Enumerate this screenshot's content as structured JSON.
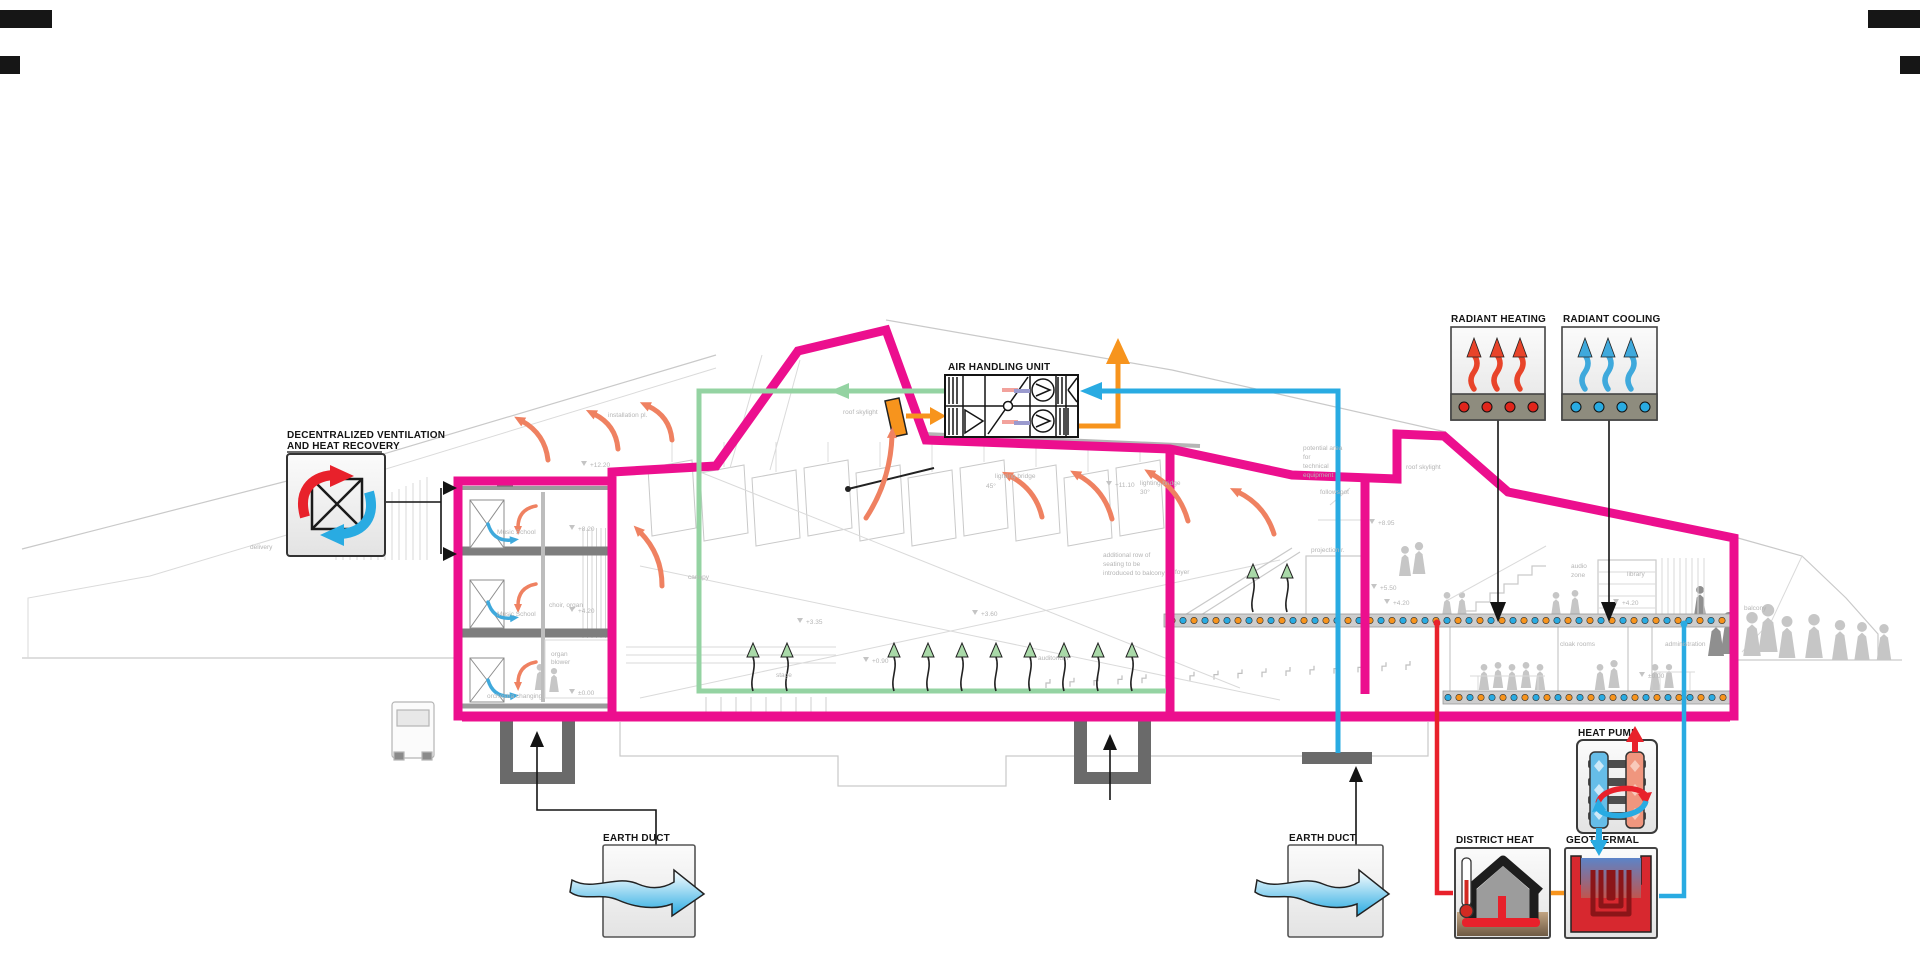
{
  "labels": {
    "decent1": "DECENTRALIZED VENTILATION",
    "decent2": "AND HEAT RECOVERY",
    "ahu": "AIR HANDLING UNIT",
    "radiant_heating": "RADIANT HEATING",
    "radiant_cooling": "RADIANT COOLING",
    "earth_duct_left": "EARTH DUCT",
    "earth_duct_right": "EARTH DUCT",
    "district_heat": "DISTRICT HEAT",
    "geothermal": "GEOTHERMAL",
    "heat_pump": "HEAT PUMP"
  },
  "colors": {
    "envelope_magenta": "#EC0F8E",
    "supply_green": "#94D3A2",
    "cool_blue": "#29ABE2",
    "warm_orange": "#F7941D",
    "exhaust_salmon": "#EF8161",
    "district_red": "#E8212B",
    "drawing_gray": "#c9c9c9"
  },
  "icons": {
    "heat_recovery_icon": "crossed red and blue rotating arrows over heat exchanger",
    "air_handling_unit_icon": "schematic with filters, cross heat exchanger and fans",
    "radiant_heating_icon": "three red wavy arrows rising from heated slab",
    "radiant_cooling_icon": "three blue wavy arrows rising from cooled slab",
    "earth_duct_icon": "blue wavy air arrow passing through ground box",
    "district_heat_icon": "house with thermometer and buried red supply pipe",
    "geothermal_icon": "red ground-loop coil below blue-to-warm gradient earth",
    "heat_pump_icon": "refrigerant cycle arrows between cold and warm coils"
  },
  "annotations": [
    {
      "text": "delivery",
      "x": 250,
      "y": 549
    },
    {
      "text": "Music School",
      "x": 497,
      "y": 534
    },
    {
      "text": "+8.20",
      "x": 578,
      "y": 531
    },
    {
      "text": "Music School",
      "x": 497,
      "y": 616
    },
    {
      "text": "+4.20",
      "x": 578,
      "y": 613
    },
    {
      "text": "orchestra changing",
      "x": 487,
      "y": 698
    },
    {
      "text": "±0.00",
      "x": 578,
      "y": 695
    },
    {
      "text": "+12.20",
      "x": 590,
      "y": 467
    },
    {
      "text": "choir, organ",
      "x": 549,
      "y": 607
    },
    {
      "text": "organ",
      "x": 551,
      "y": 656
    },
    {
      "text": "blower",
      "x": 551,
      "y": 664
    },
    {
      "text": "installation pl.",
      "x": 608,
      "y": 417
    },
    {
      "text": "roof skylight",
      "x": 843,
      "y": 414
    },
    {
      "text": "canopy",
      "x": 688,
      "y": 579
    },
    {
      "text": "stage",
      "x": 776,
      "y": 677
    },
    {
      "text": "+3.35",
      "x": 806,
      "y": 624
    },
    {
      "text": "+0.90",
      "x": 872,
      "y": 663
    },
    {
      "text": "+3.60",
      "x": 981,
      "y": 616
    },
    {
      "text": "auditorium",
      "x": 1038,
      "y": 660
    },
    {
      "text": "45°",
      "x": 986,
      "y": 488
    },
    {
      "text": "lighting bridge",
      "x": 995,
      "y": 478
    },
    {
      "text": "+11.10",
      "x": 1115,
      "y": 487
    },
    {
      "text": "lighting bridge",
      "x": 1140,
      "y": 485
    },
    {
      "text": "30°",
      "x": 1140,
      "y": 494
    },
    {
      "text": "additional row of",
      "x": 1103,
      "y": 557
    },
    {
      "text": "seating to be",
      "x": 1103,
      "y": 566
    },
    {
      "text": "introduced to balcony",
      "x": 1103,
      "y": 575
    },
    {
      "text": "potential area",
      "x": 1303,
      "y": 450
    },
    {
      "text": "for",
      "x": 1303,
      "y": 459
    },
    {
      "text": "technical",
      "x": 1303,
      "y": 468
    },
    {
      "text": "equipment",
      "x": 1303,
      "y": 477
    },
    {
      "text": "followspot",
      "x": 1320,
      "y": 494
    },
    {
      "text": "projection r.",
      "x": 1311,
      "y": 552
    },
    {
      "text": "roof skylight",
      "x": 1406,
      "y": 469
    },
    {
      "text": "+8.95",
      "x": 1378,
      "y": 525
    },
    {
      "text": "+5.50",
      "x": 1380,
      "y": 590
    },
    {
      "text": "+4.20",
      "x": 1393,
      "y": 605
    },
    {
      "text": "foyer",
      "x": 1175,
      "y": 574
    },
    {
      "text": "audio",
      "x": 1571,
      "y": 568
    },
    {
      "text": "zone",
      "x": 1571,
      "y": 577
    },
    {
      "text": "library",
      "x": 1627,
      "y": 576
    },
    {
      "text": "+4.20",
      "x": 1622,
      "y": 605
    },
    {
      "text": "balcony",
      "x": 1744,
      "y": 610
    },
    {
      "text": "cloak rooms",
      "x": 1560,
      "y": 646
    },
    {
      "text": "administration",
      "x": 1665,
      "y": 646
    },
    {
      "text": "±0.00",
      "x": 1648,
      "y": 678
    }
  ]
}
